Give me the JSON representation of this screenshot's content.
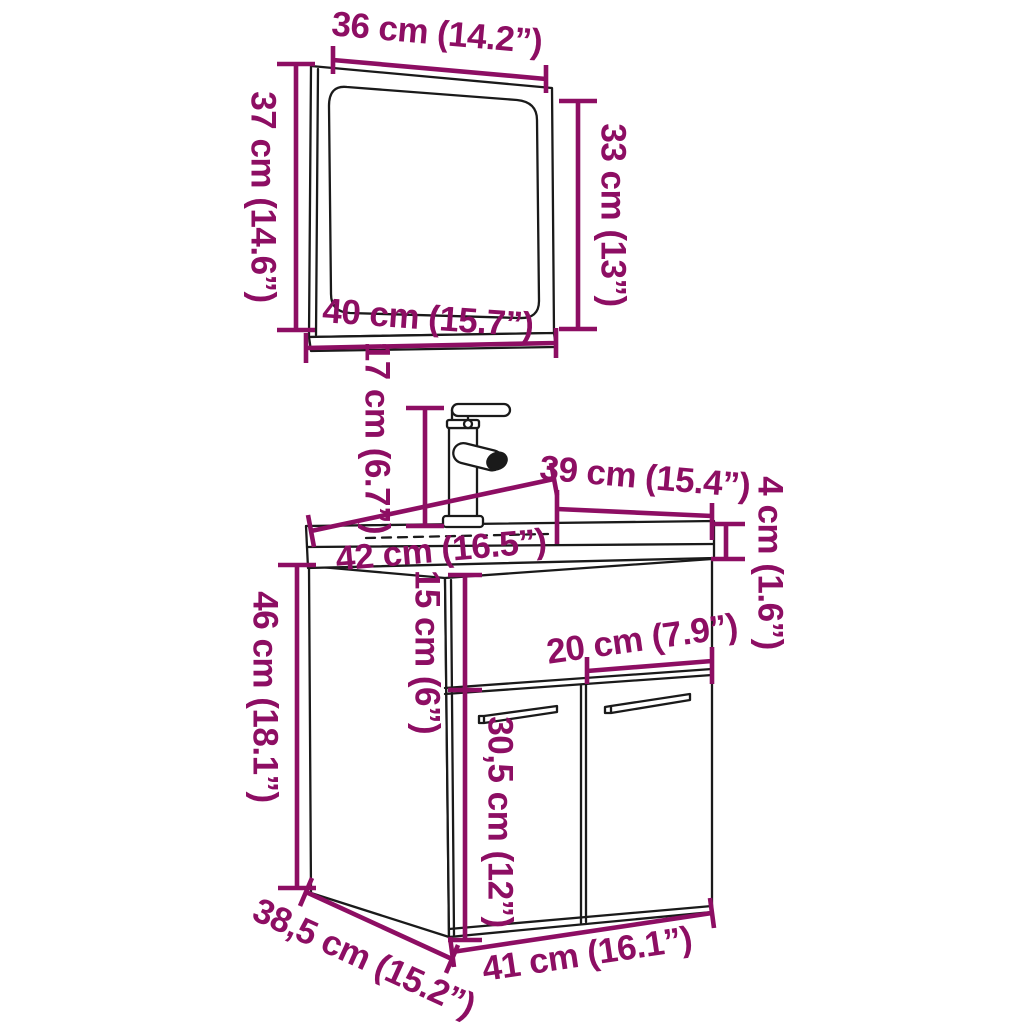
{
  "diagram": {
    "type": "furniture-dimension-diagram",
    "subject": "bathroom vanity cabinet with sink, faucet and mirror",
    "colors": {
      "background": "#ffffff",
      "line": "#1a1a1a",
      "dimension": "#8d0e63"
    },
    "mirror": {
      "width_label": "36 cm (14.2”)",
      "height_label": "37 cm (14.6”)",
      "glass_height_label": "33 cm (13”)",
      "bottom_width_label": "40 cm (15.7”)"
    },
    "faucet": {
      "height_label": "17 cm (6.7”)"
    },
    "sink": {
      "depth_label": "39 cm (15.4”)",
      "thickness_label": "4 cm (1.6”)",
      "width_label": "42 cm (16.5”)"
    },
    "cabinet": {
      "top_section_height_label": "15 cm (6”)",
      "door_width_label": "20 cm (7.9”)",
      "door_height_label": "30,5 cm (12”)",
      "height_label": "46 cm (18.1”)",
      "depth_label": "38,5 cm (15.2”)",
      "width_label": "41 cm (16.1”)"
    }
  }
}
